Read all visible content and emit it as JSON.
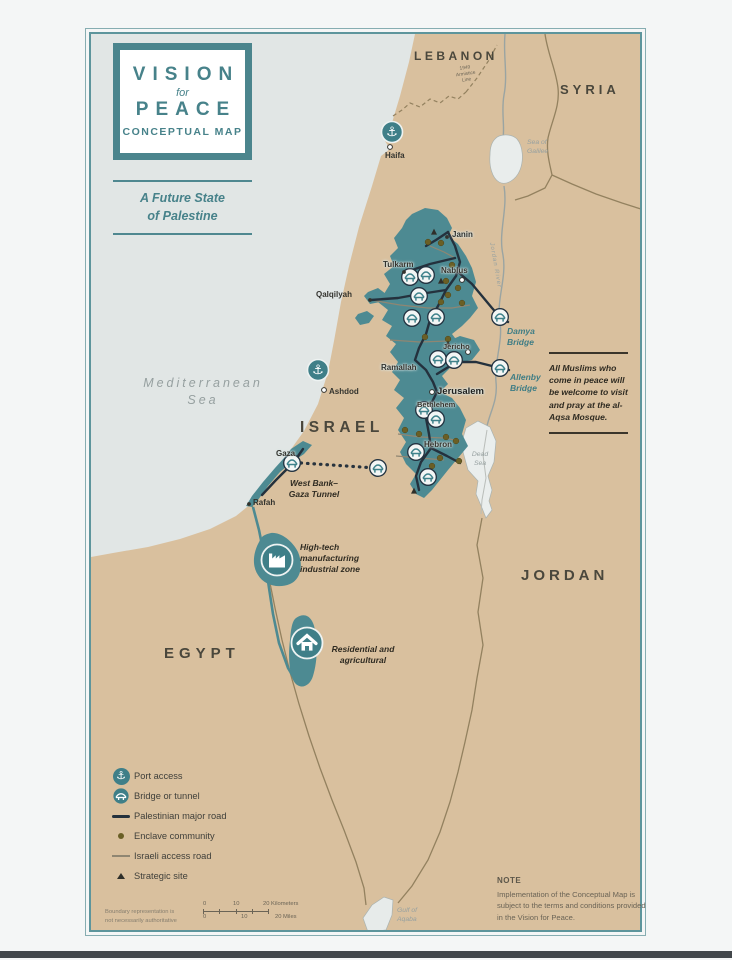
{
  "title_block": {
    "line1": "VISION",
    "line2": "for",
    "line3": "PEACE",
    "line4": "CONCEPTUAL MAP"
  },
  "subtitle": "A Future State\nof Palestine",
  "countries": {
    "lebanon": "LEBANON",
    "syria": "SYRIA",
    "israel": "ISRAEL",
    "jordan": "JORDAN",
    "egypt": "EGYPT"
  },
  "waters": {
    "mediterranean": "Mediterranean\nSea",
    "sea_of_galilee": "Sea of\nGalilee",
    "dead_sea": "Dead\nSea",
    "gulf_of_aqaba": "Gulf of\nAqaba",
    "jordan_river": "Jordan River",
    "armistice_line": "1949\nArmistice\nLine"
  },
  "cities": {
    "haifa": "Haifa",
    "ashdod": "Ashdod",
    "janin": "Janin",
    "tulkarm": "Tulkarm",
    "nablus": "Nablus",
    "qalqilyah": "Qalqilyah",
    "ramallah": "Ramallah",
    "jericho": "Jericho",
    "jerusalem": "Jerusalem",
    "bethlehem": "Bethlehem",
    "hebron": "Hebron",
    "gaza": "Gaza",
    "rafah": "Rafah"
  },
  "bridges": {
    "damya": "Damya\nBridge",
    "allenby": "Allenby\nBridge"
  },
  "zones": {
    "tunnel": "West Bank–\nGaza Tunnel",
    "high_tech": "High-tech\nmanufacturing\nindustrial zone",
    "residential": "Residential and\nagricultural"
  },
  "aqsa_note": "All Muslims who come in peace will be welcome to visit and pray at the al-Aqsa Mosque.",
  "legend": {
    "port": "Port access",
    "bridge_tunnel": "Bridge or tunnel",
    "palestinian_road": "Palestinian major road",
    "enclave_community": "Enclave community",
    "israeli_road": "Israeli access road",
    "strategic_site": "Strategic site"
  },
  "note": {
    "heading": "NOTE",
    "body": "Implementation of the Conceptual Map is subject to the terms and conditions provided in the Vision for Peace."
  },
  "scale_bar": {
    "km": [
      "0",
      "10",
      "20 Kilometers"
    ],
    "miles": [
      "0",
      "10",
      "20 Miles"
    ],
    "disclaimer": "Boundary representation is\nnot necessarily authoritative"
  },
  "colors": {
    "palestine_teal": "#4d8a92",
    "land_tan": "#d9c09e",
    "sea_gray": "#e1e6e5",
    "road_dark": "#24313d",
    "icon_teal": "#3f7f88"
  }
}
